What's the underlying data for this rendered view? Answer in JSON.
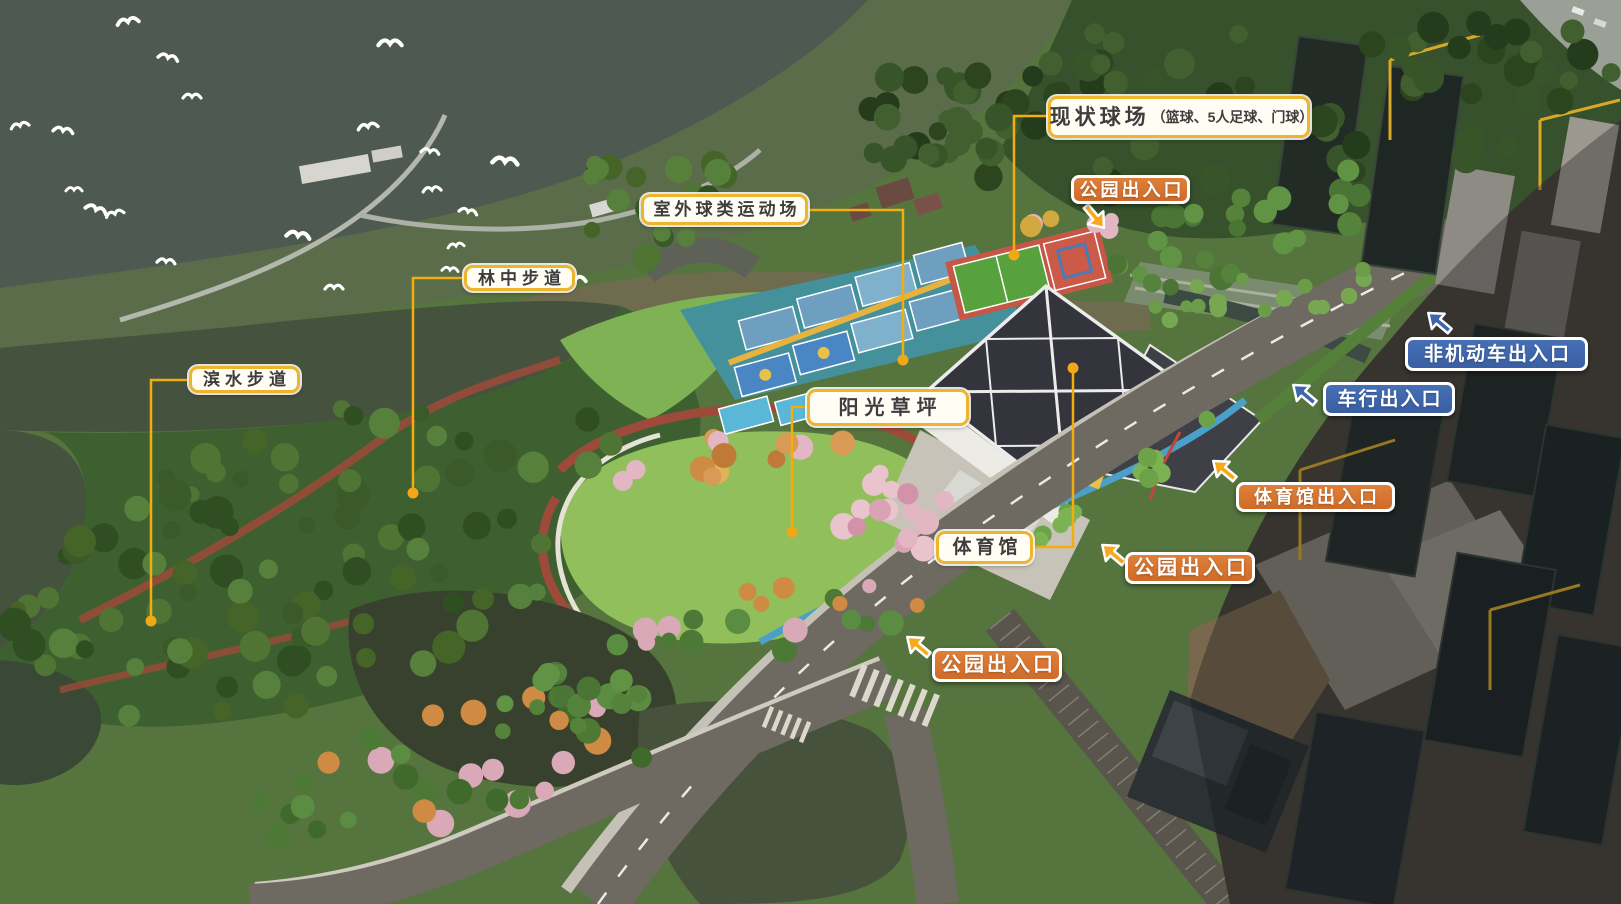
{
  "scene": {
    "description": "aerial-rendering-sports-park-masterplan",
    "palette": {
      "water_top": "#4e5a51",
      "lake": "#45523e",
      "pond": "#38412e",
      "forest_dark": "#36512c",
      "pine_forest": "#3e6030",
      "lawn": "#90bf5b",
      "jogging_path_red": "#9e4a3a",
      "road_gray": "#6e6a62",
      "gym_roof": "#34343d",
      "courts_deck_teal": "#44919c",
      "court_blue": "#6f9fc0",
      "soccer_green": "#58a23e",
      "court_red": "#c65747",
      "construction_dim": "#2a2c28",
      "crane_yellow": "#d8a828",
      "cherry_pink": "#e3b6c3",
      "autumn_orange": "#cf8b43"
    },
    "annotation_colors": {
      "label_white_bg": "#fffdf4",
      "label_gold_border": "#ecb52c",
      "label_orange_bg": "#d9742f",
      "label_blue_bg": "#3f66ad",
      "leader_yellow": "#f2ad0e",
      "arrow_gold": "#f7a81b",
      "arrow_blue": "#3f66ad",
      "text_dark": "#3d3d3d",
      "text_white": "#ffffff"
    }
  },
  "callouts": {
    "existing_courts": {
      "title": "现状球场",
      "subtitle": "（篮球、5人足球、门球）"
    },
    "outdoor_ball_area": {
      "label": "室外球类运动场"
    },
    "forest_trail": {
      "label": "林中步道"
    },
    "waterside_trail": {
      "label": "滨水步道"
    },
    "sunny_lawn": {
      "label": "阳光草坪"
    },
    "gymnasium": {
      "label": "体育馆"
    },
    "park_entrance_top": {
      "label": "公园出入口"
    },
    "park_entrance_middle": {
      "label": "公园出入口"
    },
    "park_entrance_bottom": {
      "label": "公园出入口"
    },
    "gym_entrance": {
      "label": "体育馆出入口"
    },
    "non_motorized_entrance": {
      "label": "非机动车出入口"
    },
    "vehicle_entrance": {
      "label": "车行出入口"
    }
  }
}
